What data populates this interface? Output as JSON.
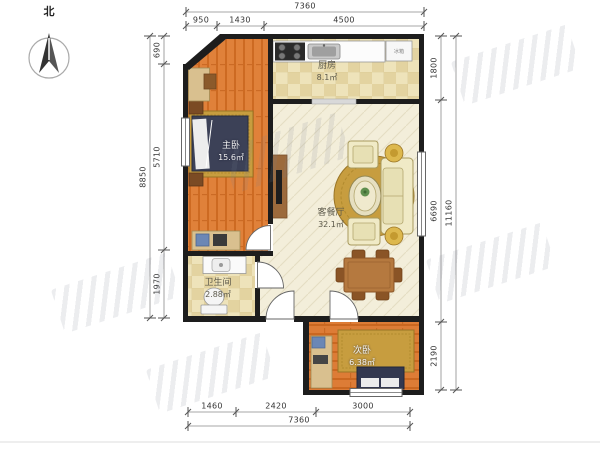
{
  "compass": {
    "north_label": "北"
  },
  "rooms": {
    "kitchen": {
      "name": "厨房",
      "area": "8.1㎡"
    },
    "master_bedroom": {
      "name": "主卧",
      "area": "15.6㎡"
    },
    "living_dining": {
      "name": "客餐厅",
      "area": "32.1㎡"
    },
    "bathroom": {
      "name": "卫生间",
      "area": "2.88㎡"
    },
    "second_bedroom": {
      "name": "次卧",
      "area": "6.38㎡"
    }
  },
  "appliances": {
    "fridge_label": "冰箱"
  },
  "dimensions": {
    "top": {
      "total": "7360",
      "segments": [
        "950",
        "1430",
        "4500"
      ]
    },
    "bottom": {
      "total": "7360",
      "segments": [
        "1460",
        "2420",
        "3000"
      ]
    },
    "left": {
      "total": "8850",
      "segments": [
        "690",
        "5710",
        "1970"
      ]
    },
    "right": {
      "total": "11160",
      "segments": [
        "1800",
        "6690",
        "2190"
      ]
    }
  },
  "colors": {
    "wall": "#1d1d1d",
    "wood_floor": "#e0813a",
    "tile_floor": "#eee3ba",
    "living_floor": "#f3eeda",
    "rug": "#c79d3f",
    "bed": "#3c4157",
    "dimension_text": "#333333"
  }
}
